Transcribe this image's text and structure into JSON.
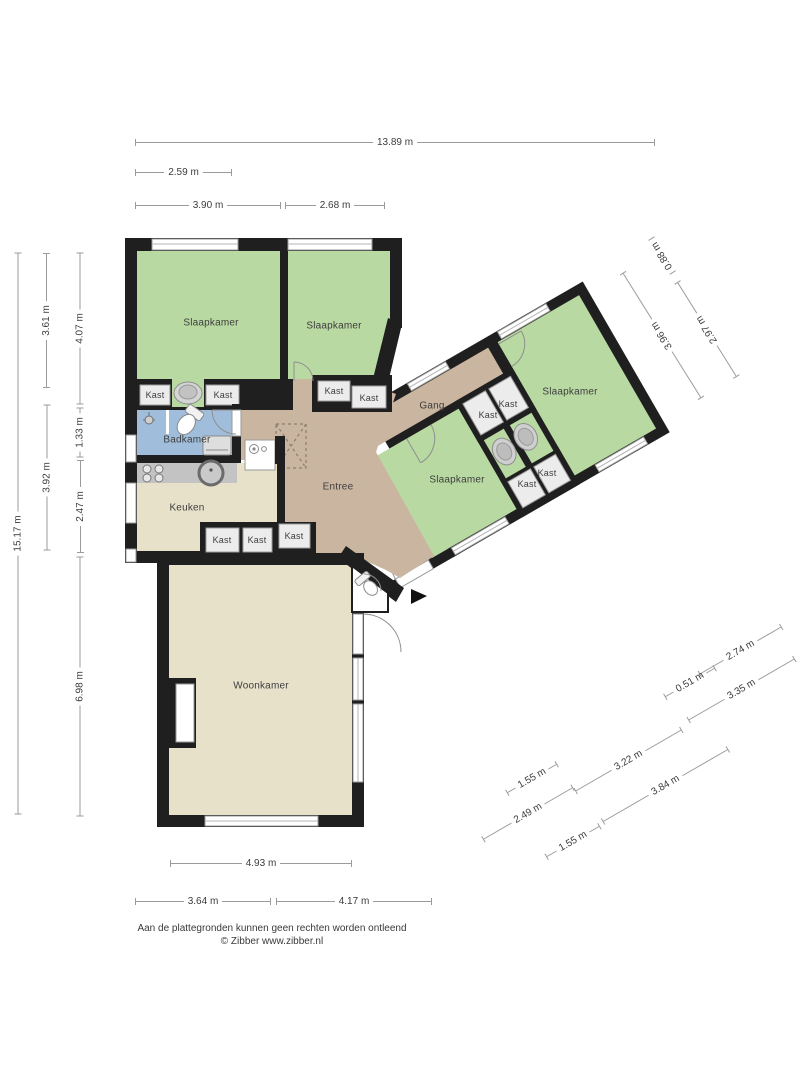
{
  "rooms": {
    "slaapkamer_links": "Slaapkamer",
    "slaapkamer_midden": "Slaapkamer",
    "slaapkamer_rechtsboven": "Slaapkamer",
    "slaapkamer_rechtsonder": "Slaapkamer",
    "badkamer": "Badkamer",
    "keuken": "Keuken",
    "entree": "Entree",
    "gang": "Gang",
    "woonkamer": "Woonkamer",
    "kast": "Kast"
  },
  "measurements": {
    "top": [
      "13.89 m",
      "2.59 m",
      "3.90 m",
      "2.68 m"
    ],
    "left": [
      "15.17 m",
      "3.61 m",
      "3.92 m",
      "4.07 m",
      "1.33 m",
      "2.47 m",
      "6.98 m"
    ],
    "bottom": [
      "4.93 m",
      "3.64 m",
      "4.17 m"
    ],
    "wing_top": [
      "0.88 m",
      "2.97 m",
      "3.96 m"
    ],
    "wing_bottom": [
      "2.74 m",
      "0.51 m",
      "3.35 m",
      "1.55 m",
      "3.22 m",
      "2.49 m",
      "3.84 m",
      "1.55 m"
    ]
  },
  "footer": {
    "disclaimer": "Aan de plattegronden kunnen geen rechten worden ontleend",
    "copyright": "© Zibber www.zibber.nl"
  },
  "colors": {
    "wall": "#1f1f1f",
    "bedroom_green": "#b9d9a2",
    "hall_tan": "#cab5a0",
    "living_cream": "#e8e1ca",
    "bath_blue": "#a0bedc",
    "counter_gray": "#c3c3c3",
    "closet_fill": "#ececec",
    "dim_line": "#9b9b9b"
  }
}
